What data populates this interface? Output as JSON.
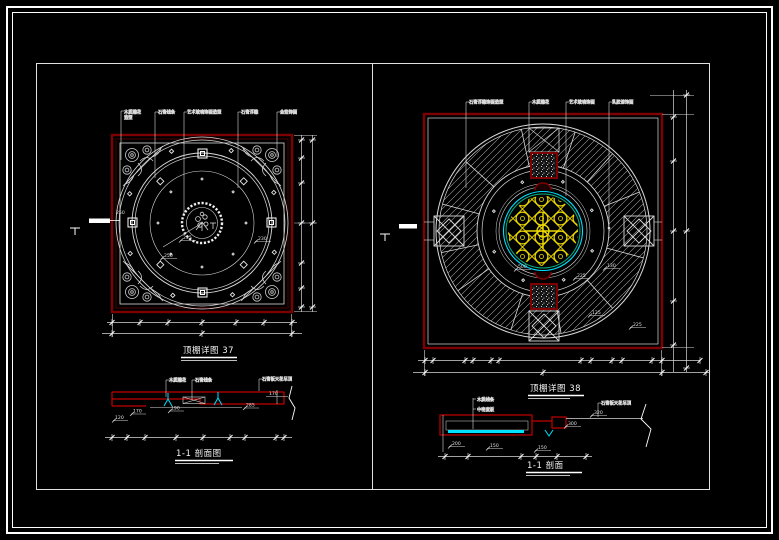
{
  "colors": {
    "background": "#000000",
    "frame_white": "#ffffff",
    "plan_border_red": "#7e0000",
    "section_red": "#c40000",
    "ornament_yellow": "#ecd800",
    "glass_cyan": "#00e0ff",
    "ring_teal": "#00b080",
    "line_white": "#d9d9d9"
  },
  "sheet": {
    "left": {
      "plan_title": "顶棚详图 37",
      "section_title": "1-1 剖面图",
      "plan_labels": [
        {
          "line1": "木质雕花",
          "line2": "造型"
        },
        {
          "line1": "石膏线条"
        },
        {
          "line1": "艺术玻璃饰面造型"
        },
        {
          "line1": "石膏浮雕"
        },
        {
          "line1": "金箔饰面"
        }
      ],
      "plan_dims": [
        "255",
        "250",
        "230"
      ],
      "section_labels": [
        "木质雕花",
        "石膏线条",
        "石膏板天花吊顶"
      ],
      "section_dims": [
        "120",
        "170",
        "190",
        "285",
        "170"
      ]
    },
    "right": {
      "plan_title": "顶棚详图 38",
      "section_title": "1-1 剖面",
      "plan_labels": [
        "石膏浮雕饰面造型",
        "木质雕花",
        "艺术玻璃饰面",
        "乳胶漆饰面"
      ],
      "plan_dims": [
        "500",
        "130",
        "225",
        "125",
        "225"
      ],
      "section_labels": [
        "木质线条",
        "中密度板",
        "石膏板天花吊顶"
      ],
      "section_dims": [
        "200",
        "150",
        "300",
        "320",
        "150"
      ]
    }
  }
}
